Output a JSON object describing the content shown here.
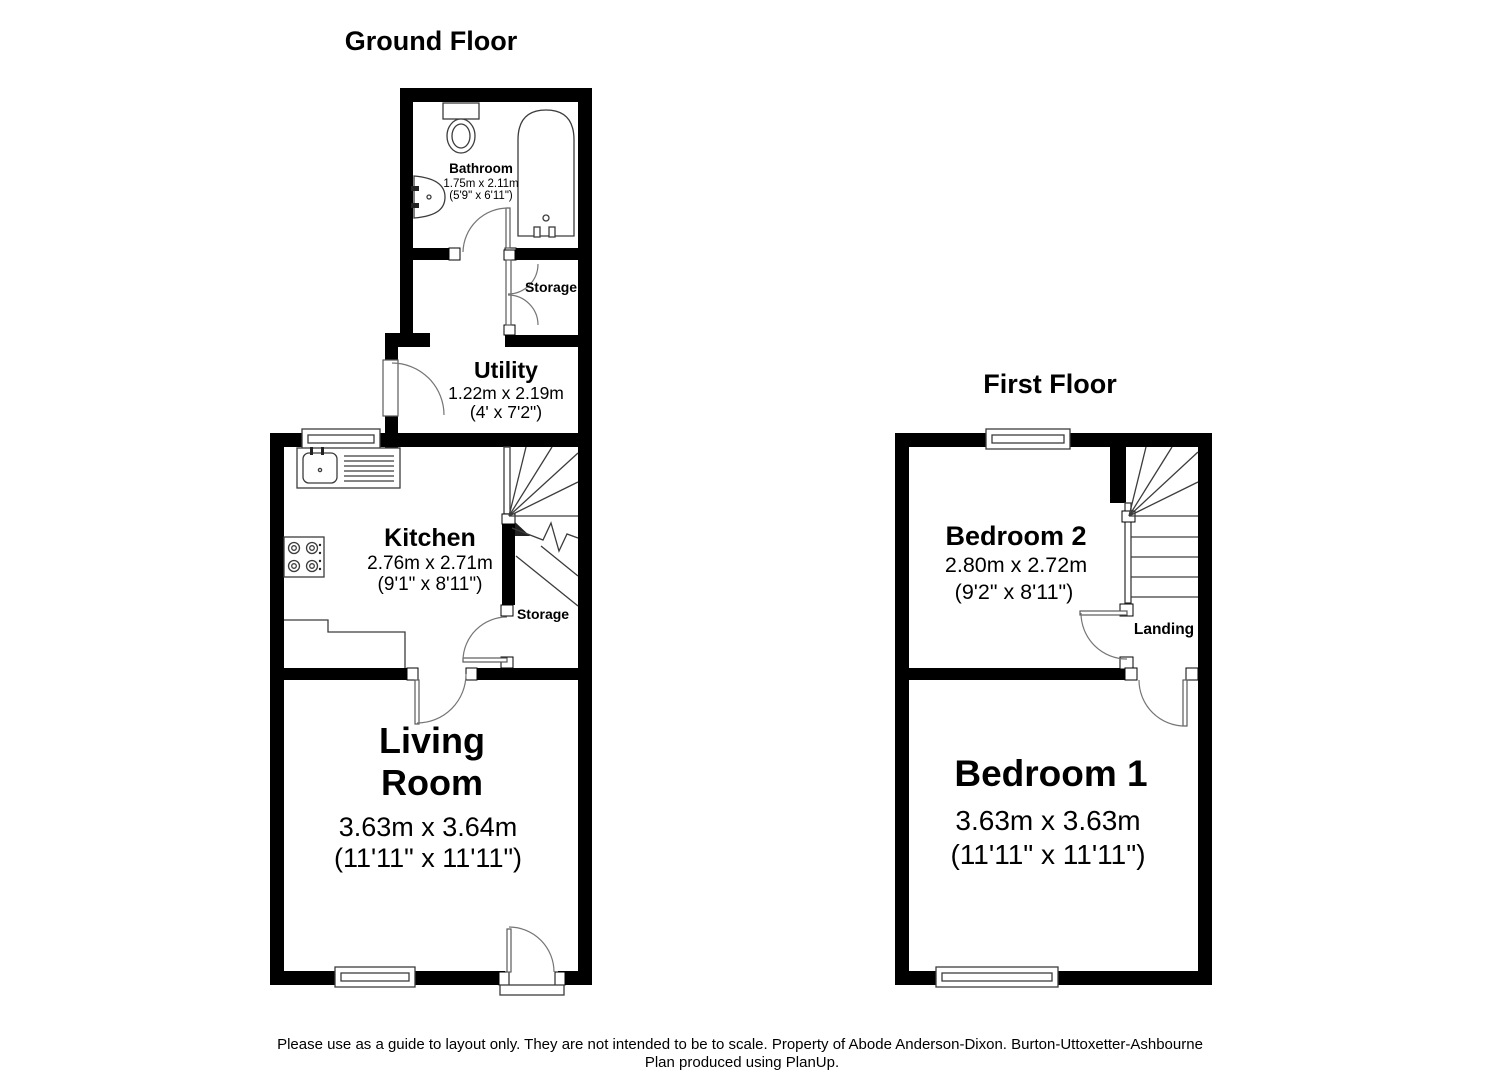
{
  "page": {
    "background_color": "#ffffff",
    "wall_color": "#000000",
    "line_color": "#3c3c3c",
    "door_arc_color": "#757575"
  },
  "ground_floor": {
    "title": "Ground Floor",
    "rooms": {
      "bathroom": {
        "name": "Bathroom",
        "dims_metric": "1.75m x 2.11m",
        "dims_imperial": "(5'9\" x 6'11\")"
      },
      "storage_upper": {
        "name": "Storage"
      },
      "utility": {
        "name": "Utility",
        "dims_metric": "1.22m x 2.19m",
        "dims_imperial": "(4' x 7'2\")"
      },
      "kitchen": {
        "name": "Kitchen",
        "dims_metric": "2.76m x 2.71m",
        "dims_imperial": "(9'1\" x 8'11\")"
      },
      "storage_understairs": {
        "name": "Storage"
      },
      "living_room": {
        "name_line1": "Living",
        "name_line2": "Room",
        "dims_metric": "3.63m x 3.64m",
        "dims_imperial": "(11'11\" x 11'11\")"
      }
    }
  },
  "first_floor": {
    "title": "First Floor",
    "rooms": {
      "bedroom2": {
        "name": "Bedroom 2",
        "dims_metric": "2.80m x 2.72m",
        "dims_imperial": "(9'2\" x 8'11\")"
      },
      "landing": {
        "name": "Landing"
      },
      "bedroom1": {
        "name": "Bedroom 1",
        "dims_metric": "3.63m x 3.63m",
        "dims_imperial": "(11'11\" x 11'11\")"
      }
    }
  },
  "footer": {
    "line1": "Please use as a guide to layout only. They are not intended to be to scale. Property of Abode Anderson-Dixon. Burton-Uttoxetter-Ashbourne",
    "line2": "Plan produced using PlanUp."
  }
}
